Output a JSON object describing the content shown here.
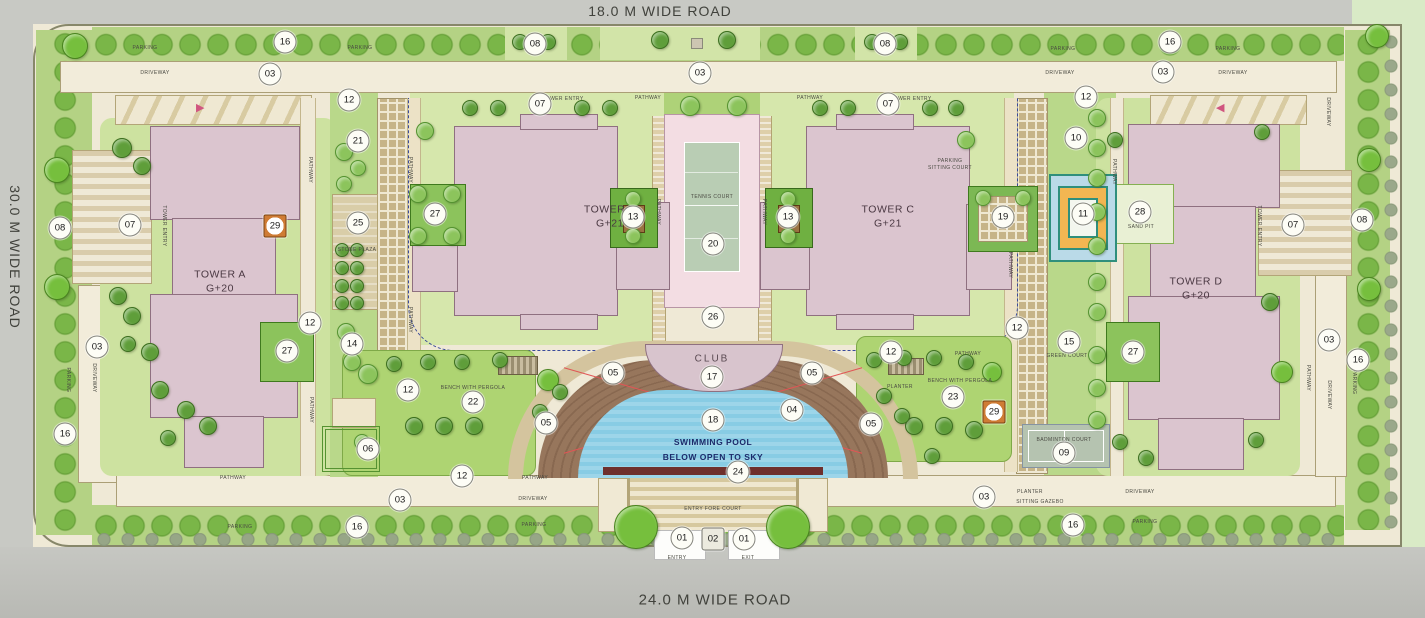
{
  "roads": {
    "top": "18.0 M WIDE ROAD",
    "left": "30.0 M WIDE ROAD",
    "bottom": "24.0 M WIDE ROAD"
  },
  "towers": [
    {
      "name": "TOWER A",
      "floors": "G+20"
    },
    {
      "name": "TOWER B",
      "floors": "G+21"
    },
    {
      "name": "TOWER C",
      "floors": "G+21"
    },
    {
      "name": "TOWER D",
      "floors": "G+20"
    }
  ],
  "colors": {
    "building": "#dbc5cf",
    "pool": "#88cce4",
    "deck": "#93725a",
    "lawn": "#cde2a0",
    "road": "#c8c9c4",
    "tennis_court": "#b9cdb4",
    "marker_orange": "#cf7c35",
    "dashed_line": "#3a4a9a"
  },
  "markers": [
    {
      "t": "01",
      "x": 682,
      "y": 538
    },
    {
      "t": "02",
      "x": 713,
      "y": 539,
      "c": "sq"
    },
    {
      "t": "01",
      "x": 744,
      "y": 539
    },
    {
      "t": "03",
      "x": 270,
      "y": 74
    },
    {
      "t": "03",
      "x": 700,
      "y": 73
    },
    {
      "t": "03",
      "x": 1163,
      "y": 72
    },
    {
      "t": "03",
      "x": 97,
      "y": 347
    },
    {
      "t": "03",
      "x": 1329,
      "y": 340
    },
    {
      "t": "03",
      "x": 400,
      "y": 500
    },
    {
      "t": "03",
      "x": 984,
      "y": 497
    },
    {
      "t": "04",
      "x": 792,
      "y": 410
    },
    {
      "t": "05",
      "x": 613,
      "y": 373
    },
    {
      "t": "05",
      "x": 812,
      "y": 373
    },
    {
      "t": "05",
      "x": 546,
      "y": 423
    },
    {
      "t": "05",
      "x": 871,
      "y": 424
    },
    {
      "t": "06",
      "x": 368,
      "y": 449
    },
    {
      "t": "07",
      "x": 130,
      "y": 225
    },
    {
      "t": "07",
      "x": 540,
      "y": 104
    },
    {
      "t": "07",
      "x": 888,
      "y": 104
    },
    {
      "t": "07",
      "x": 1293,
      "y": 225
    },
    {
      "t": "08",
      "x": 60,
      "y": 228
    },
    {
      "t": "08",
      "x": 535,
      "y": 44
    },
    {
      "t": "08",
      "x": 885,
      "y": 44
    },
    {
      "t": "08",
      "x": 1362,
      "y": 220
    },
    {
      "t": "09",
      "x": 1064,
      "y": 453
    },
    {
      "t": "10",
      "x": 1076,
      "y": 138
    },
    {
      "t": "11",
      "x": 1083,
      "y": 214
    },
    {
      "t": "12",
      "x": 349,
      "y": 100
    },
    {
      "t": "12",
      "x": 1086,
      "y": 97
    },
    {
      "t": "12",
      "x": 310,
      "y": 323
    },
    {
      "t": "12",
      "x": 408,
      "y": 390
    },
    {
      "t": "12",
      "x": 462,
      "y": 476
    },
    {
      "t": "12",
      "x": 891,
      "y": 352
    },
    {
      "t": "12",
      "x": 1017,
      "y": 328
    },
    {
      "t": "13",
      "x": 633,
      "y": 217
    },
    {
      "t": "13",
      "x": 788,
      "y": 217
    },
    {
      "t": "14",
      "x": 352,
      "y": 344
    },
    {
      "t": "15",
      "x": 1069,
      "y": 342
    },
    {
      "t": "16",
      "x": 285,
      "y": 42
    },
    {
      "t": "16",
      "x": 1170,
      "y": 42
    },
    {
      "t": "16",
      "x": 65,
      "y": 434
    },
    {
      "t": "16",
      "x": 357,
      "y": 527
    },
    {
      "t": "16",
      "x": 1073,
      "y": 525
    },
    {
      "t": "16",
      "x": 1358,
      "y": 360
    },
    {
      "t": "17",
      "x": 712,
      "y": 377
    },
    {
      "t": "18",
      "x": 713,
      "y": 420
    },
    {
      "t": "19",
      "x": 1003,
      "y": 217
    },
    {
      "t": "20",
      "x": 713,
      "y": 244
    },
    {
      "t": "21",
      "x": 358,
      "y": 141
    },
    {
      "t": "22",
      "x": 473,
      "y": 402
    },
    {
      "t": "23",
      "x": 953,
      "y": 397
    },
    {
      "t": "24",
      "x": 738,
      "y": 472
    },
    {
      "t": "25",
      "x": 358,
      "y": 223
    },
    {
      "t": "26",
      "x": 713,
      "y": 317
    },
    {
      "t": "27",
      "x": 435,
      "y": 214
    },
    {
      "t": "27",
      "x": 287,
      "y": 351
    },
    {
      "t": "27",
      "x": 1133,
      "y": 352
    },
    {
      "t": "28",
      "x": 1140,
      "y": 212
    },
    {
      "t": "29",
      "x": 275,
      "y": 226,
      "c": "sqo"
    },
    {
      "t": "29",
      "x": 994,
      "y": 412,
      "c": "sqo"
    }
  ],
  "labels": [
    {
      "t": "PARKING",
      "x": 145,
      "y": 48
    },
    {
      "t": "PARKING",
      "x": 360,
      "y": 48
    },
    {
      "t": "PARKING",
      "x": 1063,
      "y": 49
    },
    {
      "t": "PARKING",
      "x": 1228,
      "y": 49
    },
    {
      "t": "PARKING",
      "x": 240,
      "y": 527
    },
    {
      "t": "PARKING",
      "x": 534,
      "y": 525
    },
    {
      "t": "PARKING",
      "x": 1145,
      "y": 522
    },
    {
      "t": "PARKING",
      "x": 68,
      "y": 380,
      "c": "v"
    },
    {
      "t": "PARKING",
      "x": 1354,
      "y": 382,
      "c": "v"
    },
    {
      "t": "DRIVEWAY",
      "x": 155,
      "y": 73
    },
    {
      "t": "DRIVEWAY",
      "x": 1060,
      "y": 73
    },
    {
      "t": "DRIVEWAY",
      "x": 1233,
      "y": 73
    },
    {
      "t": "DRIVEWAY",
      "x": 533,
      "y": 499
    },
    {
      "t": "DRIVEWAY",
      "x": 1140,
      "y": 492
    },
    {
      "t": "DRIVEWAY",
      "x": 94,
      "y": 378,
      "c": "v"
    },
    {
      "t": "DRIVEWAY",
      "x": 1329,
      "y": 395,
      "c": "v"
    },
    {
      "t": "DRIVEWAY",
      "x": 1328,
      "y": 112,
      "c": "v"
    },
    {
      "t": "PATHWAY",
      "x": 648,
      "y": 98
    },
    {
      "t": "PATHWAY",
      "x": 810,
      "y": 98
    },
    {
      "t": "PATHWAY",
      "x": 233,
      "y": 478
    },
    {
      "t": "PATHWAY",
      "x": 535,
      "y": 478
    },
    {
      "t": "PATHWAY",
      "x": 968,
      "y": 354
    },
    {
      "t": "PATHWAY",
      "x": 410,
      "y": 170,
      "c": "v"
    },
    {
      "t": "PATHWAY",
      "x": 410,
      "y": 320,
      "c": "v"
    },
    {
      "t": "PATHWAY",
      "x": 658,
      "y": 212,
      "c": "v"
    },
    {
      "t": "PATHWAY",
      "x": 764,
      "y": 212,
      "c": "v"
    },
    {
      "t": "PATHWAY",
      "x": 1010,
      "y": 265,
      "c": "v"
    },
    {
      "t": "PATHWAY",
      "x": 1114,
      "y": 172,
      "c": "v"
    },
    {
      "t": "PATHWAY",
      "x": 310,
      "y": 170,
      "c": "v"
    },
    {
      "t": "PATHWAY",
      "x": 311,
      "y": 410,
      "c": "v"
    },
    {
      "t": "PATHWAY",
      "x": 1308,
      "y": 378,
      "c": "v"
    },
    {
      "t": "TOWER ENTRY",
      "x": 164,
      "y": 226,
      "c": "v"
    },
    {
      "t": "TOWER ENTRY",
      "x": 563,
      "y": 99
    },
    {
      "t": "TOWER ENTRY",
      "x": 911,
      "y": 99
    },
    {
      "t": "TOWER ENTRY",
      "x": 1259,
      "y": 226,
      "c": "v"
    },
    {
      "t": "STONE PLAZA",
      "x": 357,
      "y": 250
    },
    {
      "t": "PARKING",
      "x": 950,
      "y": 161
    },
    {
      "t": "SITTING COURT",
      "x": 950,
      "y": 168
    },
    {
      "t": "BENCH WITH PERGOLA",
      "x": 473,
      "y": 388
    },
    {
      "t": "BENCH WITH PERGOLA",
      "x": 960,
      "y": 381
    },
    {
      "t": "PLANTER",
      "x": 900,
      "y": 387
    },
    {
      "t": "PLANTER",
      "x": 1030,
      "y": 492
    },
    {
      "t": "SITTING GAZEBO",
      "x": 1040,
      "y": 502
    },
    {
      "t": "GREEN COURT",
      "x": 1067,
      "y": 356
    },
    {
      "t": "BADMINTON COURT",
      "x": 1064,
      "y": 440
    },
    {
      "t": "SAND PIT",
      "x": 1141,
      "y": 227
    },
    {
      "t": "ENTRY FORE COURT",
      "x": 713,
      "y": 509
    },
    {
      "t": "ENTRY",
      "x": 677,
      "y": 558
    },
    {
      "t": "EXIT",
      "x": 748,
      "y": 558
    },
    {
      "t": "TENNIS COURT",
      "x": 712,
      "y": 197
    },
    {
      "t": "CLUB",
      "x": 712,
      "y": 359,
      "c": "md"
    },
    {
      "t": "SWIMMING POOL",
      "x": 713,
      "y": 442,
      "c": "navy"
    },
    {
      "t": "BELOW OPEN TO SKY",
      "x": 713,
      "y": 457,
      "c": "navy"
    }
  ],
  "trees": [
    {
      "x": 636,
      "y": 527,
      "r": 21,
      "c": "t0"
    },
    {
      "x": 788,
      "y": 527,
      "r": 21,
      "c": "t0"
    },
    {
      "x": 75,
      "y": 46,
      "r": 12,
      "c": "t0"
    },
    {
      "x": 1377,
      "y": 36,
      "r": 11,
      "c": "t0"
    },
    {
      "x": 57,
      "y": 170,
      "r": 12,
      "c": "t0"
    },
    {
      "x": 57,
      "y": 287,
      "r": 12,
      "c": "t0"
    },
    {
      "x": 1369,
      "y": 160,
      "r": 11,
      "c": "t0"
    },
    {
      "x": 1369,
      "y": 289,
      "r": 11,
      "c": "t0"
    },
    {
      "x": 1282,
      "y": 372,
      "r": 10,
      "c": "t0"
    },
    {
      "x": 548,
      "y": 380,
      "r": 10,
      "c": "t0"
    },
    {
      "x": 992,
      "y": 372,
      "r": 9,
      "c": "t0"
    },
    {
      "x": 122,
      "y": 148,
      "r": 9,
      "c": "t2"
    },
    {
      "x": 142,
      "y": 166,
      "r": 8,
      "c": "t2"
    },
    {
      "x": 118,
      "y": 296,
      "r": 8,
      "c": "t2"
    },
    {
      "x": 132,
      "y": 316,
      "r": 8,
      "c": "t2"
    },
    {
      "x": 150,
      "y": 352,
      "r": 8,
      "c": "t2"
    },
    {
      "x": 128,
      "y": 344,
      "r": 7,
      "c": "t2"
    },
    {
      "x": 160,
      "y": 390,
      "r": 8,
      "c": "t2"
    },
    {
      "x": 186,
      "y": 410,
      "r": 8,
      "c": "t2"
    },
    {
      "x": 208,
      "y": 426,
      "r": 8,
      "c": "t2"
    },
    {
      "x": 168,
      "y": 438,
      "r": 7,
      "c": "t2"
    },
    {
      "x": 344,
      "y": 152,
      "r": 8,
      "c": "t1"
    },
    {
      "x": 358,
      "y": 168,
      "r": 7,
      "c": "t1"
    },
    {
      "x": 344,
      "y": 184,
      "r": 7,
      "c": "t1"
    },
    {
      "x": 342,
      "y": 250,
      "r": 6,
      "c": "t2"
    },
    {
      "x": 357,
      "y": 250,
      "r": 6,
      "c": "t2"
    },
    {
      "x": 342,
      "y": 268,
      "r": 6,
      "c": "t2"
    },
    {
      "x": 357,
      "y": 268,
      "r": 6,
      "c": "t2"
    },
    {
      "x": 342,
      "y": 286,
      "r": 6,
      "c": "t2"
    },
    {
      "x": 357,
      "y": 286,
      "r": 6,
      "c": "t2"
    },
    {
      "x": 342,
      "y": 303,
      "r": 6,
      "c": "t2"
    },
    {
      "x": 357,
      "y": 303,
      "r": 6,
      "c": "t2"
    },
    {
      "x": 346,
      "y": 332,
      "r": 8,
      "c": "t1"
    },
    {
      "x": 352,
      "y": 362,
      "r": 8,
      "c": "t1"
    },
    {
      "x": 418,
      "y": 194,
      "r": 8,
      "c": "t1"
    },
    {
      "x": 452,
      "y": 194,
      "r": 8,
      "c": "t1"
    },
    {
      "x": 418,
      "y": 236,
      "r": 8,
      "c": "t1"
    },
    {
      "x": 452,
      "y": 236,
      "r": 8,
      "c": "t1"
    },
    {
      "x": 425,
      "y": 131,
      "r": 8,
      "c": "t1"
    },
    {
      "x": 470,
      "y": 108,
      "r": 7,
      "c": "t2"
    },
    {
      "x": 498,
      "y": 108,
      "r": 7,
      "c": "t2"
    },
    {
      "x": 582,
      "y": 108,
      "r": 7,
      "c": "t2"
    },
    {
      "x": 610,
      "y": 108,
      "r": 7,
      "c": "t2"
    },
    {
      "x": 690,
      "y": 106,
      "r": 9,
      "c": "t1"
    },
    {
      "x": 737,
      "y": 106,
      "r": 9,
      "c": "t1"
    },
    {
      "x": 660,
      "y": 40,
      "r": 8,
      "c": "t2"
    },
    {
      "x": 727,
      "y": 40,
      "r": 8,
      "c": "t2"
    },
    {
      "x": 520,
      "y": 42,
      "r": 7,
      "c": "t2"
    },
    {
      "x": 548,
      "y": 42,
      "r": 7,
      "c": "t2"
    },
    {
      "x": 872,
      "y": 42,
      "r": 7,
      "c": "t2"
    },
    {
      "x": 900,
      "y": 42,
      "r": 7,
      "c": "t2"
    },
    {
      "x": 633,
      "y": 199,
      "r": 7,
      "c": "t1"
    },
    {
      "x": 633,
      "y": 236,
      "r": 7,
      "c": "t1"
    },
    {
      "x": 788,
      "y": 199,
      "r": 7,
      "c": "t1"
    },
    {
      "x": 788,
      "y": 236,
      "r": 7,
      "c": "t1"
    },
    {
      "x": 820,
      "y": 108,
      "r": 7,
      "c": "t2"
    },
    {
      "x": 848,
      "y": 108,
      "r": 7,
      "c": "t2"
    },
    {
      "x": 930,
      "y": 108,
      "r": 7,
      "c": "t2"
    },
    {
      "x": 956,
      "y": 108,
      "r": 7,
      "c": "t2"
    },
    {
      "x": 966,
      "y": 140,
      "r": 8,
      "c": "t1"
    },
    {
      "x": 983,
      "y": 198,
      "r": 7,
      "c": "t1"
    },
    {
      "x": 1023,
      "y": 198,
      "r": 7,
      "c": "t1"
    },
    {
      "x": 1097,
      "y": 118,
      "r": 8,
      "c": "t1"
    },
    {
      "x": 1097,
      "y": 148,
      "r": 8,
      "c": "t1"
    },
    {
      "x": 1097,
      "y": 178,
      "r": 8,
      "c": "t1"
    },
    {
      "x": 1097,
      "y": 212,
      "r": 8,
      "c": "t1"
    },
    {
      "x": 1097,
      "y": 246,
      "r": 8,
      "c": "t1"
    },
    {
      "x": 1097,
      "y": 282,
      "r": 8,
      "c": "t1"
    },
    {
      "x": 1097,
      "y": 312,
      "r": 8,
      "c": "t1"
    },
    {
      "x": 1097,
      "y": 355,
      "r": 8,
      "c": "t1"
    },
    {
      "x": 1097,
      "y": 388,
      "r": 8,
      "c": "t1"
    },
    {
      "x": 1097,
      "y": 420,
      "r": 8,
      "c": "t1"
    },
    {
      "x": 1115,
      "y": 140,
      "r": 7,
      "c": "t2"
    },
    {
      "x": 1120,
      "y": 442,
      "r": 7,
      "c": "t2"
    },
    {
      "x": 1146,
      "y": 458,
      "r": 7,
      "c": "t2"
    },
    {
      "x": 1262,
      "y": 132,
      "r": 7,
      "c": "t2"
    },
    {
      "x": 1270,
      "y": 302,
      "r": 8,
      "c": "t2"
    },
    {
      "x": 1256,
      "y": 440,
      "r": 7,
      "c": "t2"
    },
    {
      "x": 368,
      "y": 374,
      "r": 9,
      "c": "t1"
    },
    {
      "x": 394,
      "y": 364,
      "r": 7,
      "c": "t2"
    },
    {
      "x": 428,
      "y": 362,
      "r": 7,
      "c": "t2"
    },
    {
      "x": 462,
      "y": 362,
      "r": 7,
      "c": "t2"
    },
    {
      "x": 500,
      "y": 360,
      "r": 7,
      "c": "t2"
    },
    {
      "x": 414,
      "y": 426,
      "r": 8,
      "c": "t2"
    },
    {
      "x": 444,
      "y": 426,
      "r": 8,
      "c": "t2"
    },
    {
      "x": 474,
      "y": 426,
      "r": 8,
      "c": "t2"
    },
    {
      "x": 362,
      "y": 442,
      "r": 7,
      "c": "t1"
    },
    {
      "x": 874,
      "y": 360,
      "r": 7,
      "c": "t2"
    },
    {
      "x": 904,
      "y": 358,
      "r": 7,
      "c": "t2"
    },
    {
      "x": 934,
      "y": 358,
      "r": 7,
      "c": "t2"
    },
    {
      "x": 966,
      "y": 362,
      "r": 7,
      "c": "t2"
    },
    {
      "x": 914,
      "y": 426,
      "r": 8,
      "c": "t2"
    },
    {
      "x": 944,
      "y": 426,
      "r": 8,
      "c": "t2"
    },
    {
      "x": 974,
      "y": 430,
      "r": 8,
      "c": "t2"
    },
    {
      "x": 932,
      "y": 456,
      "r": 7,
      "c": "t2"
    },
    {
      "x": 560,
      "y": 392,
      "r": 7,
      "c": "t2"
    },
    {
      "x": 540,
      "y": 412,
      "r": 7,
      "c": "t2"
    },
    {
      "x": 884,
      "y": 396,
      "r": 7,
      "c": "t2"
    },
    {
      "x": 902,
      "y": 416,
      "r": 7,
      "c": "t2"
    }
  ]
}
